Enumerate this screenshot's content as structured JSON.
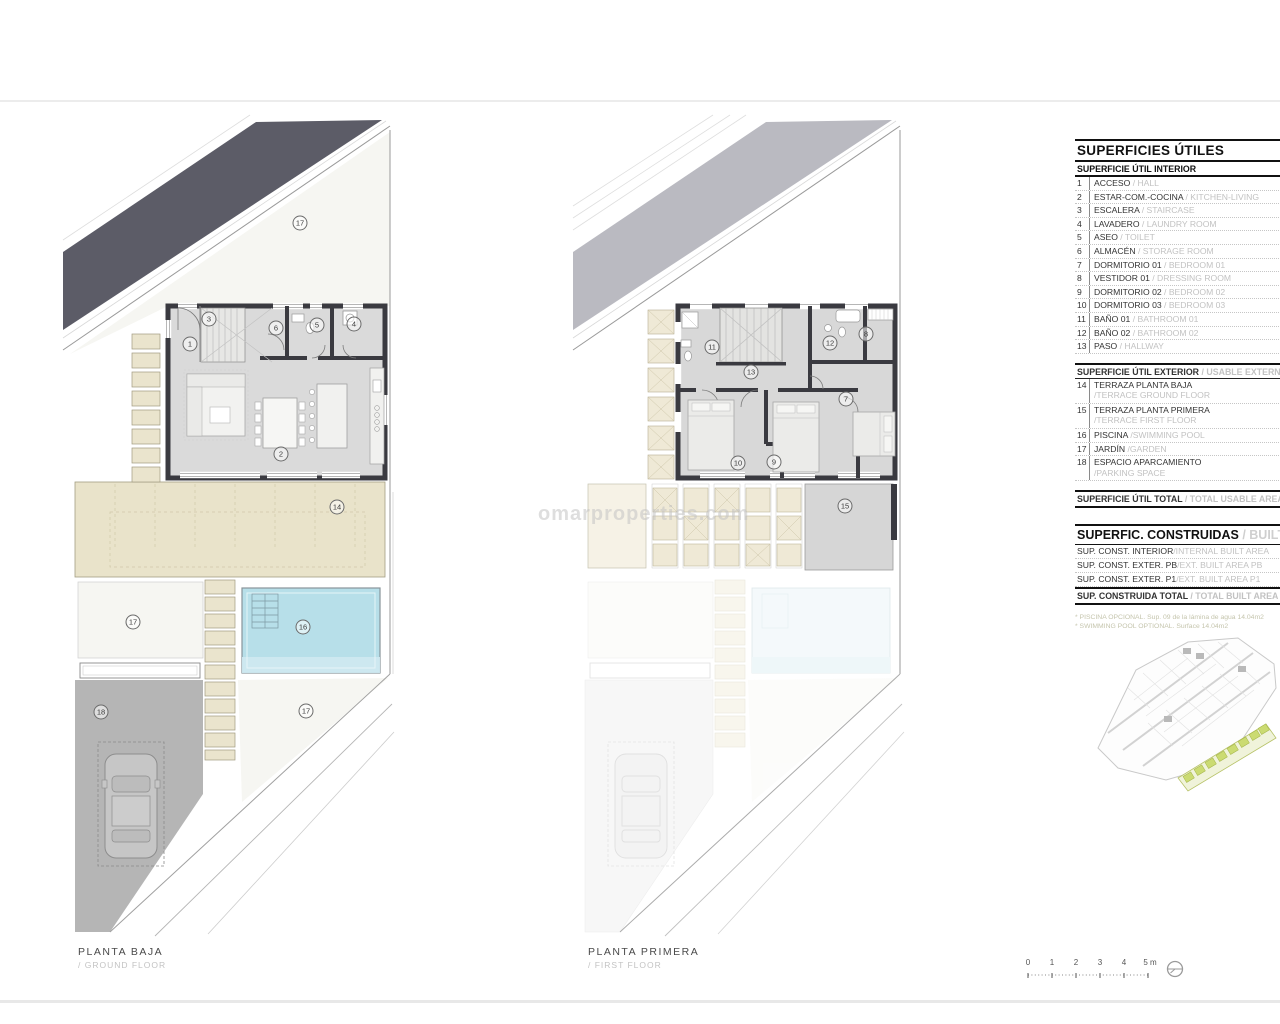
{
  "watermark": "omarproperties.com",
  "plans": {
    "ground": {
      "label": "PLANTA BAJA",
      "sublabel": "/ GROUND FLOOR",
      "badges": [
        "17",
        "1",
        "3",
        "6",
        "5",
        "4",
        "2",
        "14",
        "17",
        "16",
        "18",
        "17"
      ]
    },
    "first": {
      "label": "PLANTA PRIMERA",
      "sublabel": "/ FIRST FLOOR",
      "badges": [
        "11",
        "12",
        "8",
        "13",
        "7",
        "10",
        "9",
        "15"
      ]
    }
  },
  "legend": {
    "title": "SUPERFICIES ÚTILES",
    "interior": {
      "header": "SUPERFICIE ÚTIL INTERIOR",
      "rows": [
        {
          "num": "1",
          "name": "ACCESO",
          "en": "/ HALL"
        },
        {
          "num": "2",
          "name": "ESTAR-COM.-COCINA",
          "en": "/ KITCHEN-LIVING"
        },
        {
          "num": "3",
          "name": "ESCALERA",
          "en": "/ STAIRCASE"
        },
        {
          "num": "4",
          "name": "LAVADERO",
          "en": "/ LAUNDRY ROOM"
        },
        {
          "num": "5",
          "name": "ASEO",
          "en": "/ TOILET"
        },
        {
          "num": "6",
          "name": "ALMACÉN",
          "en": "/ STORAGE ROOM"
        },
        {
          "num": "7",
          "name": "DORMITORIO 01",
          "en": "/ BEDROOM 01"
        },
        {
          "num": "8",
          "name": "VESTIDOR 01",
          "en": "/ DRESSING ROOM"
        },
        {
          "num": "9",
          "name": "DORMITORIO 02",
          "en": "/ BEDROOM 02"
        },
        {
          "num": "10",
          "name": "DORMITORIO 03",
          "en": "/ BEDROOM 03"
        },
        {
          "num": "11",
          "name": "BAÑO 01",
          "en": "/ BATHROOM 01"
        },
        {
          "num": "12",
          "name": "BAÑO 02",
          "en": "/ BATHROOM 02"
        },
        {
          "num": "13",
          "name": "PASO",
          "en": "/ HALLWAY"
        }
      ]
    },
    "exterior": {
      "header": "SUPERFICIE ÚTIL EXTERIOR",
      "header_en": "/ USABLE EXTERNAL AREA",
      "rows": [
        {
          "num": "14",
          "name": "TERRAZA PLANTA BAJA",
          "en": "/TERRACE GROUND FLOOR"
        },
        {
          "num": "15",
          "name": "TERRAZA PLANTA PRIMERA",
          "en": "/TERRACE FIRST FLOOR"
        },
        {
          "num": "16",
          "name": "PISCINA",
          "en": "/SWIMMING POOL"
        },
        {
          "num": "17",
          "name": "JARDÍN",
          "en": "/GARDEN"
        },
        {
          "num": "18",
          "name": "ESPACIO APARCAMIENTO",
          "en": "/PARKING SPACE"
        }
      ]
    },
    "total": {
      "label": "SUPERFICIE ÚTIL TOTAL",
      "en": "/ TOTAL USABLE AREA"
    },
    "built": {
      "title": "SUPERFIC. CONSTRUIDAS",
      "title_en": "/ BUILT AREA",
      "rows": [
        {
          "name": "SUP. CONST. INTERIOR",
          "en": "/INTERNAL BUILT AREA"
        },
        {
          "name": "SUP. CONST. EXTER. PB",
          "en": "/EXT. BUILT AREA PB"
        },
        {
          "name": "SUP. CONST. EXTER. P1",
          "en": "/EXT. BUILT AREA P1"
        }
      ],
      "total": {
        "label": "SUP. CONSTRUIDA TOTAL",
        "en": "/ TOTAL BUILT AREA"
      }
    },
    "footnotes": [
      "* PISCINA OPCIONAL. Sup. 09 de la lámina de agua 14.04m2",
      "* SWIMMING POOL OPTIONAL. Surface 14.04m2"
    ]
  },
  "scalebar": {
    "ticks": [
      "0",
      "1",
      "2",
      "3",
      "4",
      "5 m"
    ]
  },
  "colors": {
    "band_dark": "#5c5c67",
    "band_light": "#babac1",
    "wall": "#3a3a40",
    "floor": "#dadada",
    "terrace_beige": "#e9e3ca",
    "pool_blue": "#b7dfe9",
    "parking_gray": "#b5b5b5",
    "step_beige": "#eae4cd",
    "minimap_green": "#cbdb72"
  }
}
